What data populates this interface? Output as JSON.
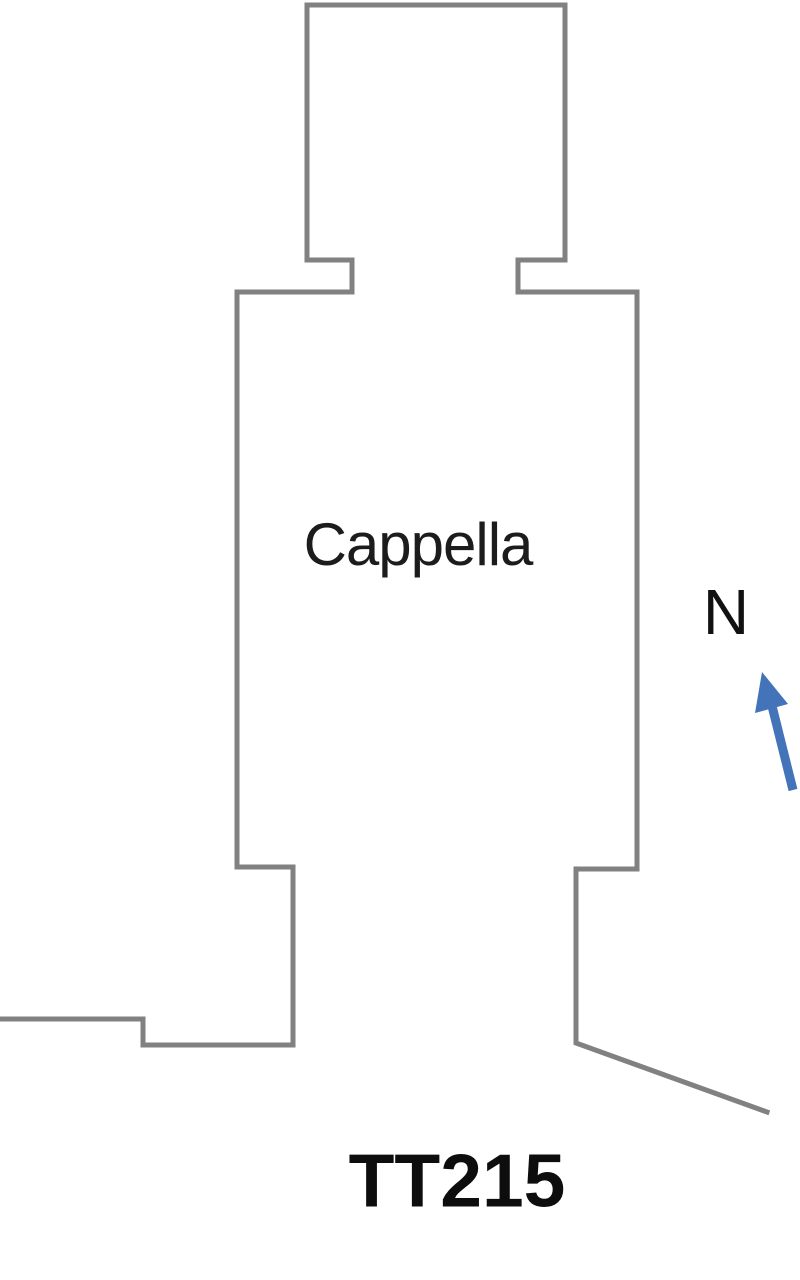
{
  "canvas": {
    "width": 800,
    "height": 1280,
    "background": "#ffffff"
  },
  "plan": {
    "wall_color": "#818181",
    "wall_thickness": 5,
    "outline_points": [
      [
        0,
        1019
      ],
      [
        143,
        1019
      ],
      [
        143,
        1045
      ],
      [
        293,
        1045
      ],
      [
        293,
        867
      ],
      [
        237,
        867
      ],
      [
        237,
        292
      ],
      [
        352,
        292
      ],
      [
        352,
        260
      ],
      [
        307,
        260
      ],
      [
        307,
        5
      ],
      [
        565,
        5
      ],
      [
        565,
        260
      ],
      [
        518,
        260
      ],
      [
        518,
        292
      ],
      [
        637,
        292
      ],
      [
        637,
        869
      ],
      [
        576,
        869
      ],
      [
        576,
        1043
      ],
      [
        767,
        1112
      ]
    ],
    "room_label": {
      "text": "Cappella",
      "x": 418,
      "y": 545,
      "font_size": 60,
      "color": "#1c1c1c"
    },
    "tomb_label": {
      "text": "TT215",
      "x": 457,
      "y": 1181,
      "font_size": 75,
      "color": "#0d0d0d"
    },
    "north": {
      "label": {
        "text": "N",
        "x": 726,
        "y": 612,
        "font_size": 64,
        "color": "#111111"
      },
      "arrow_color": "#4374b9",
      "shaft": {
        "x1": 793,
        "y1": 790,
        "x2": 772,
        "y2": 706
      },
      "head_points": "762,672 788,704 755,713"
    }
  }
}
